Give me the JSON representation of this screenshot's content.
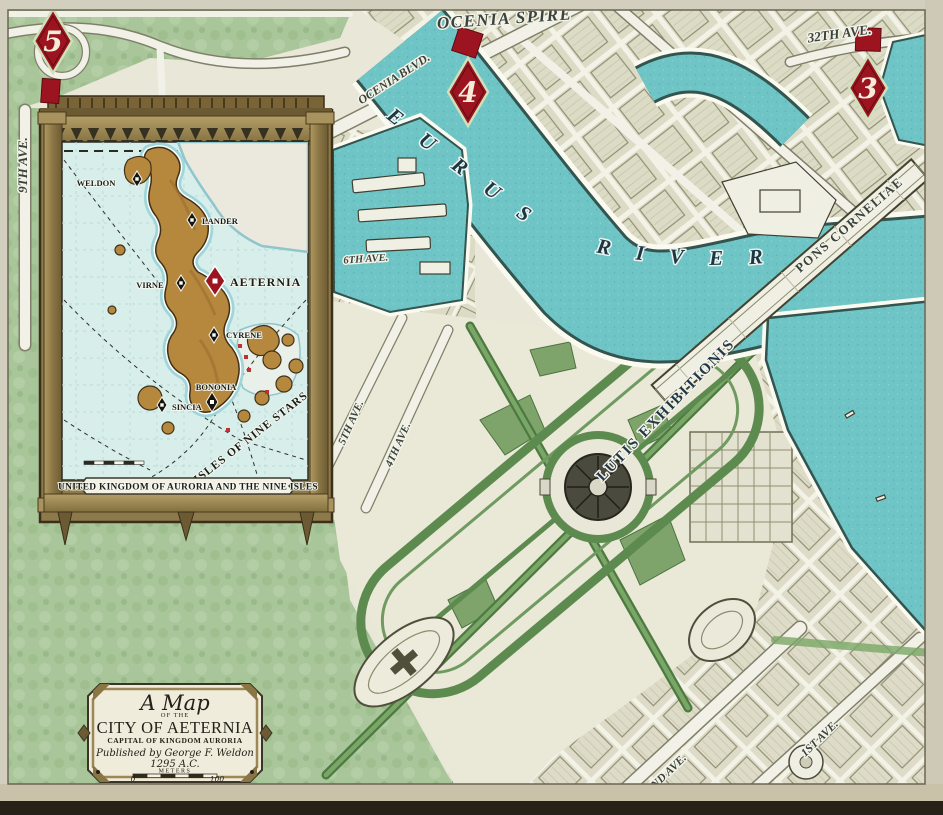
{
  "title": {
    "script_title": "A Map",
    "of_the": "OF THE",
    "city": "CITY OF AETERNIA",
    "subtitle": "CAPITAL OF KINGDOM AURORIA",
    "publisher": "Published by George F. Weldon",
    "year": "1295 A.C.",
    "scale_label": "METERS",
    "scale_start": "0",
    "scale_end": "100"
  },
  "streets": {
    "ocenia_spire": "OCENIA SPIRE",
    "ocenia_blvd": "OCENIA BLVD.",
    "ave_32": "32TH AVE.",
    "ave_9": "9TH AVE.",
    "ave_6": "6TH AVE.",
    "ave_5": "5TH AVE.",
    "ave_4": "4TH AVE.",
    "ave_2": "2ND AVE.",
    "ave_1": "1ST AVE.",
    "pons_corneliae": "PONS CORNELIAE",
    "lutis_exhibitionis": "LUTIS EXHIBITIONIS"
  },
  "river": {
    "word1": "EURUS",
    "word2": "RIVER"
  },
  "markers": [
    {
      "number": "5"
    },
    {
      "number": "4"
    },
    {
      "number": "3"
    }
  ],
  "inset": {
    "towns": [
      {
        "name": "WELDON"
      },
      {
        "name": "LANDER"
      },
      {
        "name": "VIRNE"
      },
      {
        "name": "AETERNIA"
      },
      {
        "name": "CYRENE"
      },
      {
        "name": "BONONIA"
      },
      {
        "name": "SINCIA"
      }
    ],
    "region": "ISLES OF NINE STARS",
    "banner": "UNITED KINGDOM OF AURORIA AND THE NINE ISLES"
  },
  "colors": {
    "water": "#6fc5c6",
    "land_green": "#a9c69a",
    "park_green": "#5d8b4f",
    "parchment": "#e9e7d7",
    "block": "#dcdbc6",
    "marker_red": "#9c1420",
    "frame_gold": "#9c8757",
    "ink": "#2e3a38"
  }
}
